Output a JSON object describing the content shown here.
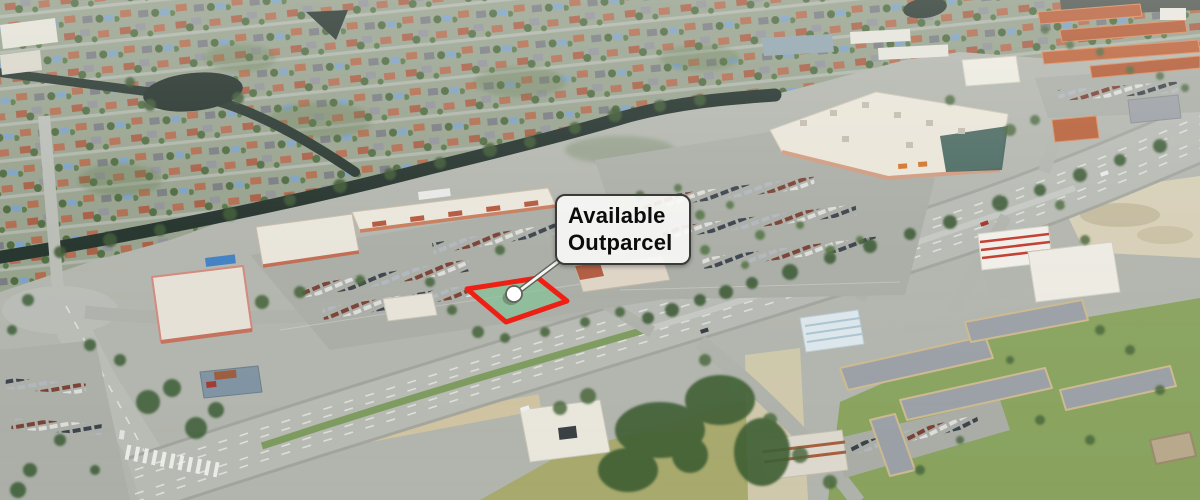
{
  "view": {
    "type": "aerial-3d-satellite-view",
    "subject": "Shopping center outparcel availability map"
  },
  "callout": {
    "line1": "Available",
    "line2": "Outparcel"
  },
  "parcel": {
    "fill_color": "#7fc694",
    "fill_opacity": "0.62",
    "outline_color": "#ee2016",
    "outline_width": "5"
  },
  "marker": {
    "fill_color": "#ffffff",
    "outline_color": "#63635c"
  }
}
